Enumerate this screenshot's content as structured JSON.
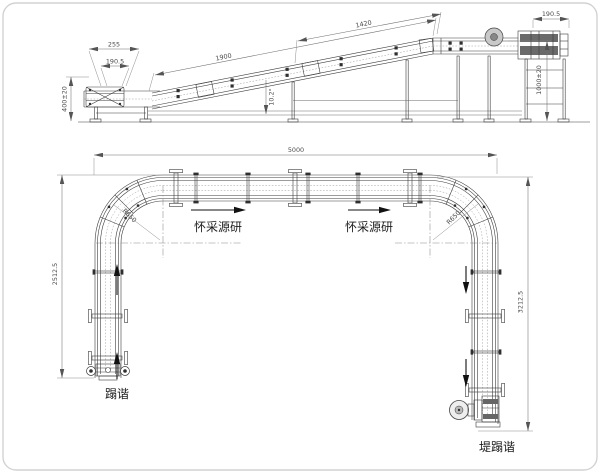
{
  "colors": {
    "line": "#3d3d3d",
    "dimension_line": "#6e6e6e",
    "text": "#1c1c1c",
    "border": "#d2d2d2",
    "background": "#ffffff"
  },
  "elevation_view": {
    "dims": {
      "tail_width": "255",
      "tail_belt_width": "190.5",
      "infeed_height": "400±20",
      "incline_length": "1900",
      "upper_length": "1420",
      "incline_angle": "10.2°",
      "head_width": "190.5",
      "discharge_height": "1000±20"
    }
  },
  "plan_view": {
    "dims": {
      "overall_length": "5000",
      "left_run_length": "2512.5",
      "right_run_length": "3212.5",
      "left_corner_radius": "R650",
      "right_corner_radius": "R650"
    },
    "labels": {
      "flow_left": "怀采源研",
      "flow_right": "怀采源研",
      "infeed": "蹋谐",
      "discharge": "堤蹋谐"
    }
  }
}
